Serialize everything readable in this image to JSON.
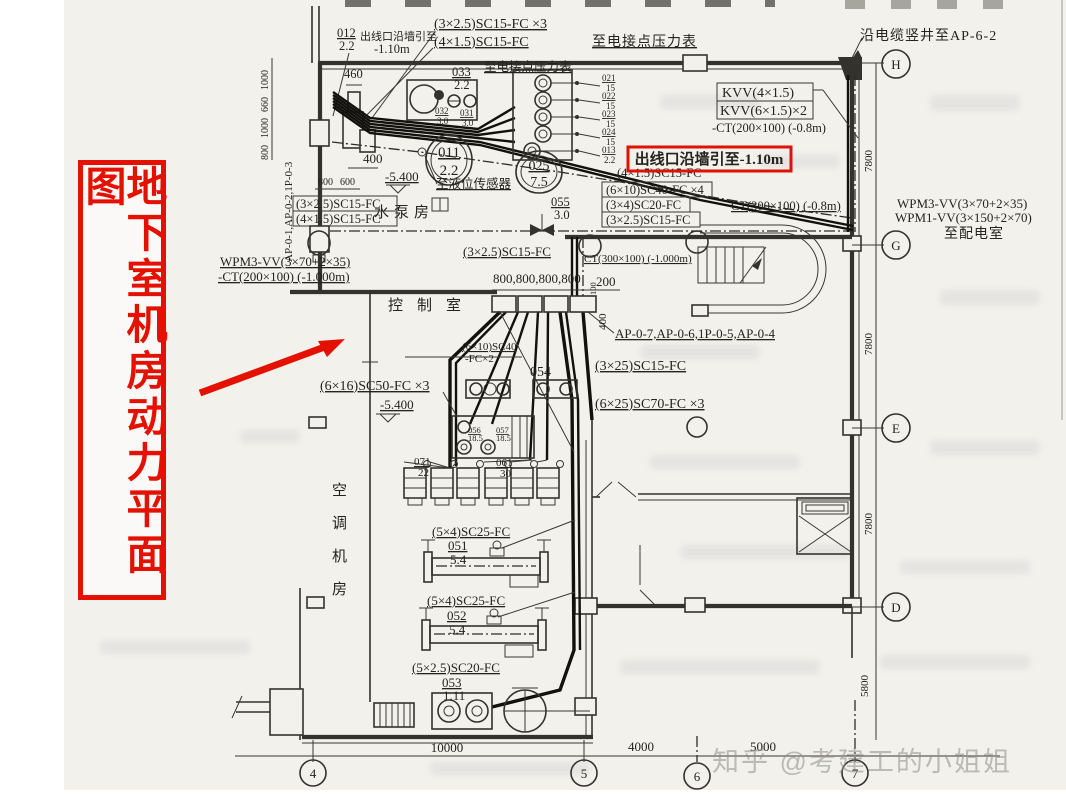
{
  "title": "地下室机房动力平面图",
  "watermark": "知乎 @考建工的小姐姐",
  "rooms": {
    "pump": "水泵房",
    "control": "控制室",
    "ac": [
      "空",
      "调",
      "机",
      "房"
    ]
  },
  "cn": {
    "outlet_top": "出线口沿墙引至",
    "outlet_top2": "-1.10m",
    "outlet_red": "出线口沿墙引至-1.10m",
    "gauge_top": "至电接点压力表",
    "gauge_mid": "至电接点压力表",
    "level_sensor": "至液位传感器",
    "shaft": "沿电缆竖井至AP-6-2",
    "dist_room": "至配电室"
  },
  "ap": {
    "left_v": "AP-0-1,AP-0-2,1P-0-3",
    "mid": "AP-0-7,AP-0-6,1P-0-5,AP-0-4"
  },
  "cables": {
    "sc25_3": "(3×2.5)SC15-FC ×3",
    "sc15_4": "(4×1.5)SC15-FC",
    "kvv1": "KVV(4×1.5)",
    "kvv2": "KVV(6×1.5)×2",
    "ct200_08": "-CT(200×100) (-0.8m)",
    "sc15_4b": "(4×1.5)SC15-FC",
    "sc40_4": "(6×10)SC40-FC ×4",
    "sc20_34": "(3×4)SC20-FC",
    "sc15_25r": "(3×2.5)SC15-FC",
    "ct300_08": "CT(300×100) (-0.8m)",
    "wpm3r": "WPM3-VV(3×70+2×35)",
    "wpm1r": "WPM1-VV(3×150+2×70)",
    "sc15_25L": "(3×2.5)SC15-FC",
    "sc15_4L": "(4×1.5)SC15-FC",
    "wpm3l": "WPM3-VV(3×70+2×35)",
    "ct200_1": "-CT(200×100) (-1.000m)",
    "ct300_1": "CT(300×100) (-1.000m)",
    "sc15_25m": "(3×2.5)SC15-FC",
    "sc40_2a": "(6×10)SC40",
    "sc40_2b": "-FC×2",
    "sc50": "(6×16)SC50-FC ×3",
    "sc15_325": "(3×25)SC15-FC",
    "sc70": "(6×25)SC70-FC ×3",
    "sc25a": "(5×4)SC25-FC",
    "sc25b": "(5×4)SC25-FC",
    "sc20b": "(5×2.5)SC20-FC"
  },
  "eq": {
    "e012": {
      "n": "012",
      "d": "2.2"
    },
    "e033": {
      "n": "033",
      "d": "2.2"
    },
    "e032": {
      "n": "032",
      "d": "3.0"
    },
    "e031": {
      "n": "031",
      "d": "3.0"
    },
    "e011": {
      "n": "011",
      "d": "2.2"
    },
    "e021": {
      "n": "021",
      "d": "15"
    },
    "e022": {
      "n": "022",
      "d": "15"
    },
    "e023": {
      "n": "023",
      "d": "15"
    },
    "e024": {
      "n": "024",
      "d": "15"
    },
    "e013": {
      "n": "013",
      "d": "2.2"
    },
    "e025": {
      "n": "025",
      "d": "7.5"
    },
    "e055": {
      "n": "055",
      "d": "3.0"
    },
    "e054": "054",
    "e056": {
      "n": "056",
      "d": "18.5"
    },
    "e057": {
      "n": "057",
      "d": "18.5"
    },
    "e071": {
      "n": "071",
      "d": "22"
    },
    "e061": {
      "n": "061",
      "d": "30"
    },
    "e051": {
      "n": "051",
      "d": "5.4"
    },
    "e052": {
      "n": "052",
      "d": "5.4"
    },
    "e053": {
      "n": "053",
      "d": "1.11"
    }
  },
  "dims": {
    "d460": "460",
    "d400": "400",
    "d800": "800",
    "d600": "600",
    "v1000a": "1000",
    "v660": "660",
    "v1000b": "1000",
    "v800": "800",
    "r800": "800,800,800,800",
    "d200": "200",
    "d100": "100",
    "d400v": "400",
    "lvl1": "-5.400",
    "lvl2": "-5.400",
    "d10000": "10000",
    "d4000": "4000",
    "d5000": "5000",
    "d78a": "7800",
    "d78b": "7800",
    "d78c": "7800",
    "d58": "5800"
  },
  "grid": {
    "H": "H",
    "G": "G",
    "E": "E",
    "D": "D",
    "c4": "4",
    "c5": "5",
    "c6": "6",
    "c7": "7"
  }
}
